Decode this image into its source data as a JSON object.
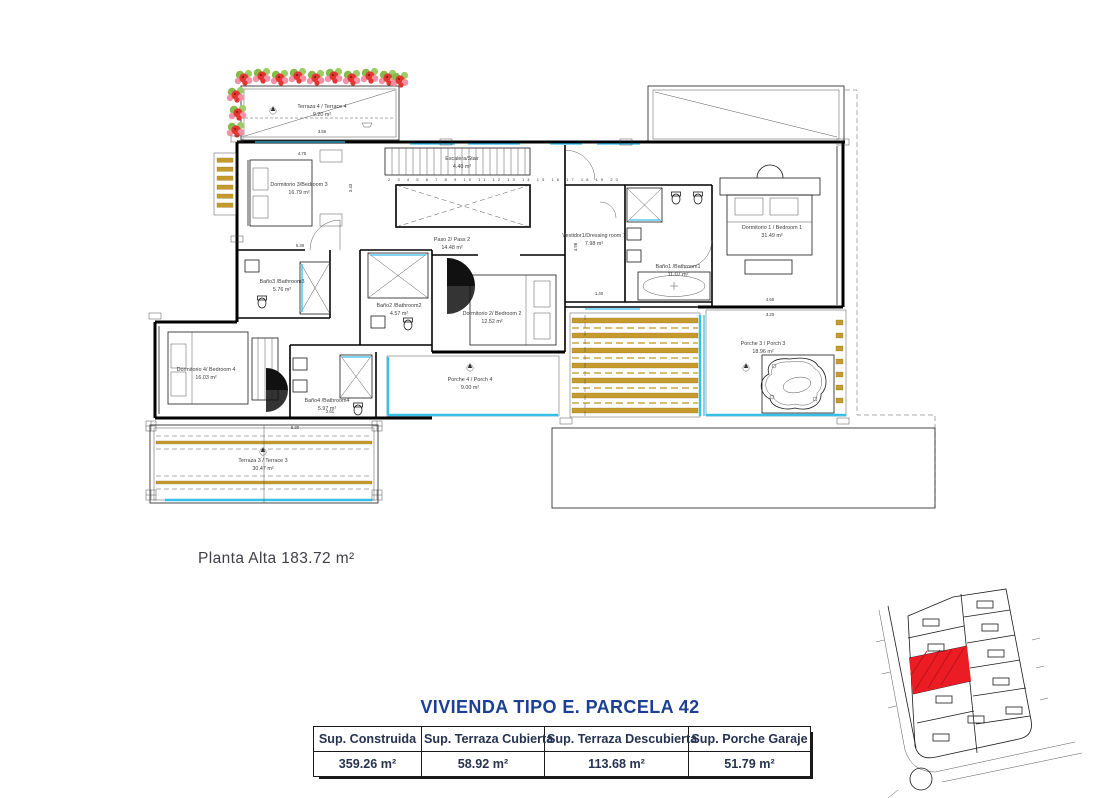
{
  "document": {
    "floor_label": "Planta Alta 183.72 m²"
  },
  "title_block": {
    "title": "VIVIENDA TIPO E. PARCELA 42",
    "columns": [
      "Sup. Construida",
      "Sup. Terraza Cubierta",
      "Sup. Terraza Descubierta",
      "Sup. Porche Garaje"
    ],
    "values": [
      "359.26 m²",
      "58.92 m²",
      "113.68 m²",
      "51.79 m²"
    ]
  },
  "rooms": {
    "terrace4": {
      "label": "Terraza 4 / Terrace 4",
      "area": "9.20 m²"
    },
    "bedroom3": {
      "label": "Dormitorio 3/Bedroom 3",
      "area": "16.79 m²"
    },
    "stair": {
      "label": "Escalera/Stair",
      "area": "4.40 m²"
    },
    "paso2": {
      "label": "Paso 2/ Pass 2",
      "area": "14.48 m²"
    },
    "dressing1": {
      "label": "Vestidor1/Dressing room 1",
      "area": "7.98 m²"
    },
    "bath1": {
      "label": "Baño1 /Bathroom1",
      "area": "11.07 m²"
    },
    "bedroom1": {
      "label": "Dormitorio 1 / Bedroom 1",
      "area": "31.49 m²"
    },
    "bedroom2": {
      "label": "Dormitorio 2/ Bedroom 2",
      "area": "12.52 m²"
    },
    "bath2": {
      "label": "Baño2 /Bathroom2",
      "area": "4.57 m²"
    },
    "bath3": {
      "label": "Baño3 /Bathroom3",
      "area": "5.76 m²"
    },
    "bedroom4": {
      "label": "Dormitorio 4/ Bedroom 4",
      "area": "16.03 m²"
    },
    "bath4": {
      "label": "Baño4 /Bathroom4",
      "area": "5.97 m²"
    },
    "porch4": {
      "label": "Porche 4 / Porch 4",
      "area": "9.00 m²"
    },
    "porch3": {
      "label": "Porche 3 / Porch 3",
      "area": "18.96 m²"
    },
    "terrace3": {
      "label": "Terraza 3 / Terrace 3",
      "area": "30.47 m²"
    }
  },
  "stair_numbers": "2 3 4 5 6 7 8 9 10 11 12 13 14 15 16 17 18 19 20",
  "dims": [
    "3.56",
    "4.75",
    "3.43",
    "5.30",
    "1.40",
    "4.60",
    "3.20",
    "2.61",
    "5.30",
    "4.98"
  ],
  "colors": {
    "glass": "#36bfe9",
    "louver_gold": "#c49b2c",
    "flower_red": "#e33631",
    "flower_pink": "#f191a5",
    "leaf_green": "#86bb4b",
    "highlight_parcel": "#ec1c24",
    "title_blue": "#1c3f94"
  }
}
